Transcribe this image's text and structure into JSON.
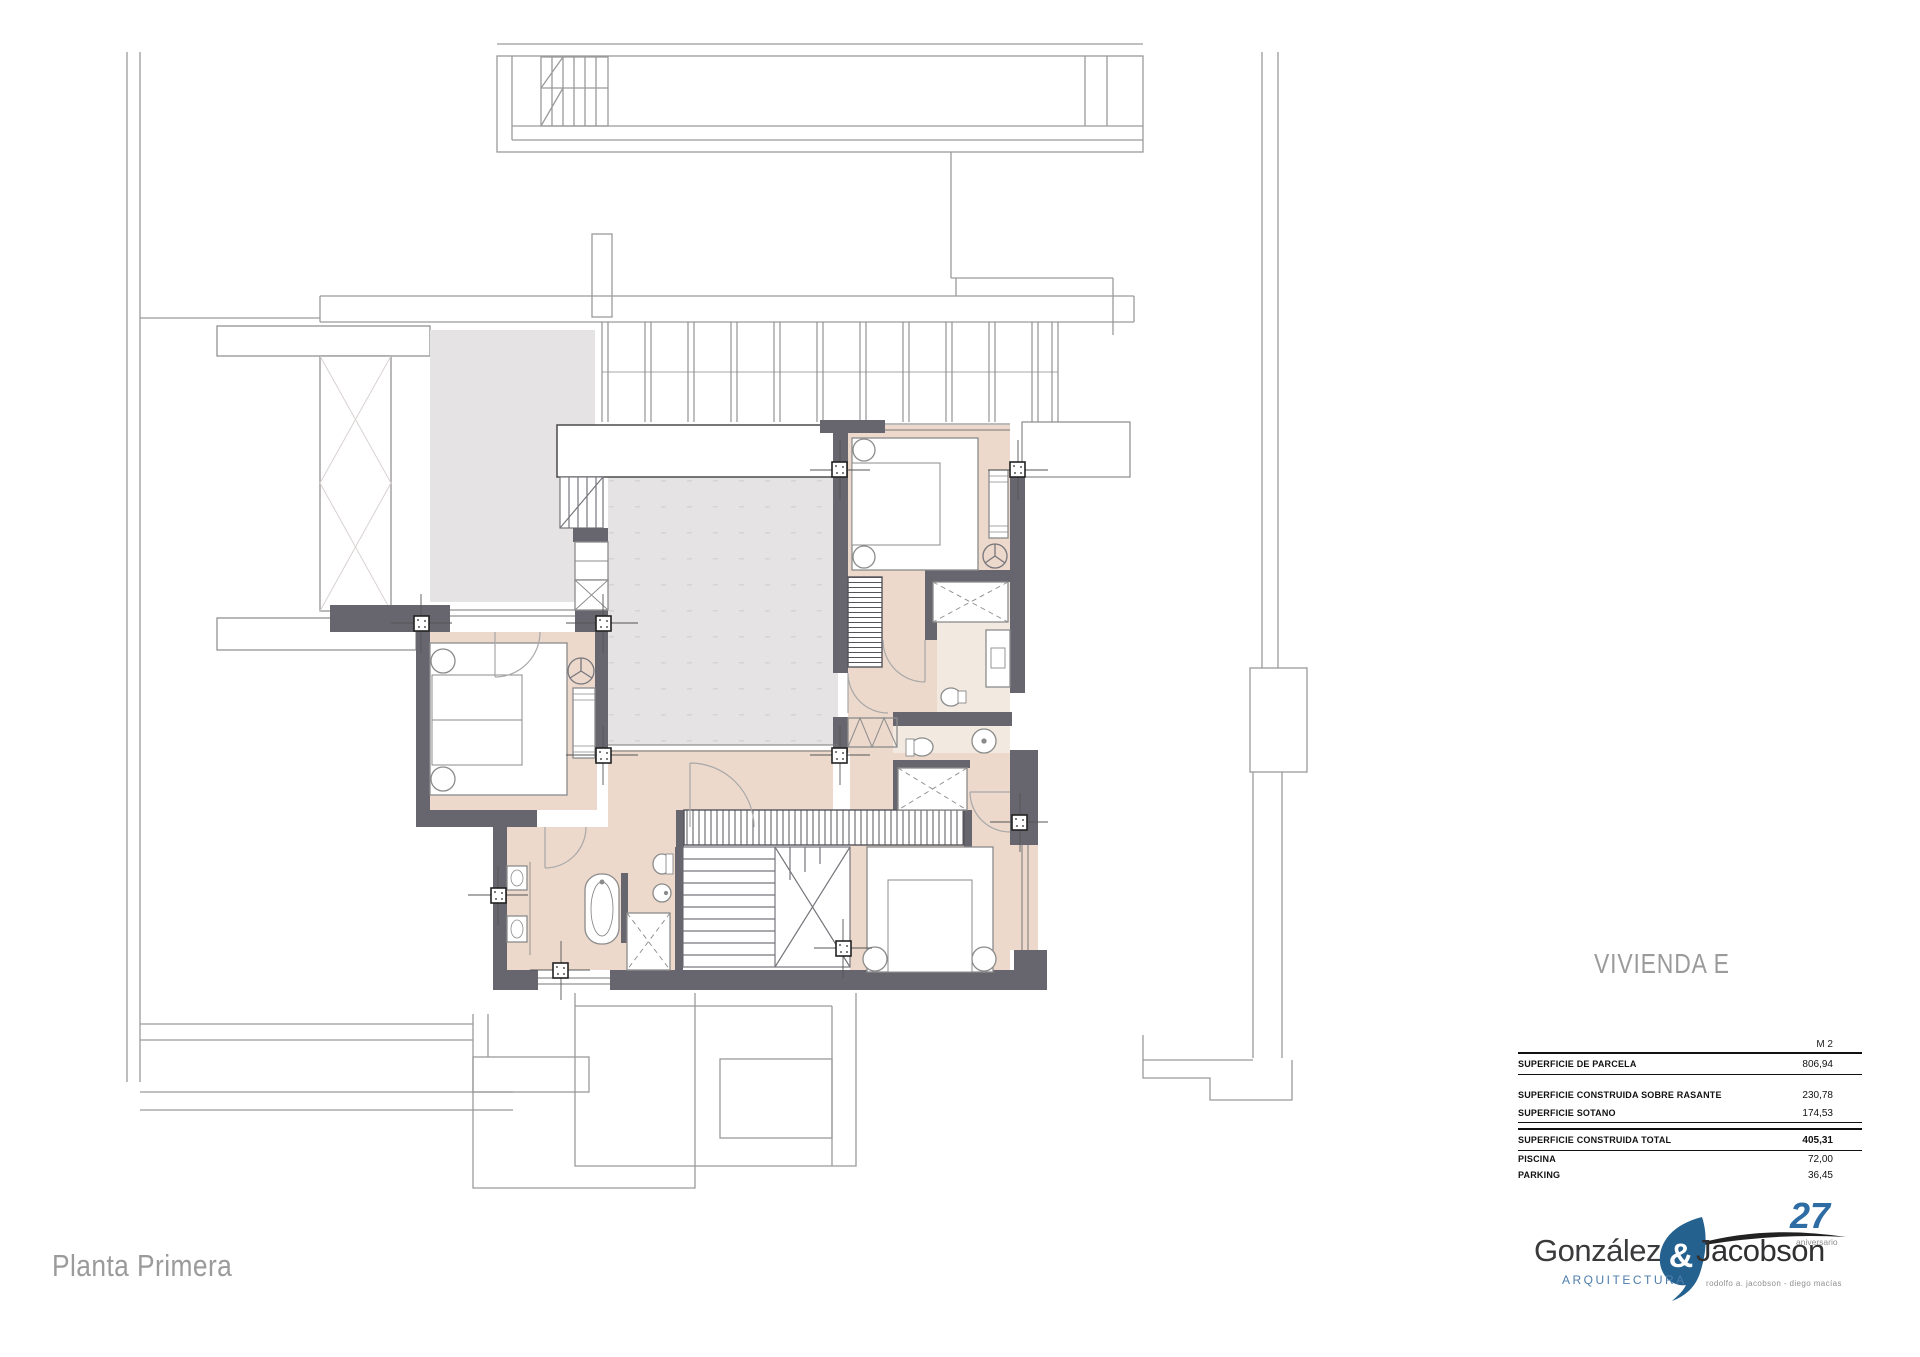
{
  "project": {
    "title": "VIVIENDA E",
    "floor_label": "Planta Primera"
  },
  "area_table": {
    "unit_header": "M 2",
    "rows": [
      {
        "label": "SUPERFICIE DE PARCELA",
        "value": "806,94"
      },
      {
        "label": "SUPERFICIE CONSTRUIDA SOBRE RASANTE",
        "value": "230,78"
      },
      {
        "label": "SUPERFICIE SOTANO",
        "value": "174,53"
      },
      {
        "label": "SUPERFICIE CONSTRUIDA TOTAL",
        "value": "405,31"
      },
      {
        "label": "PISCINA",
        "value": "72,00"
      },
      {
        "label": "PARKING",
        "value": "36,45"
      }
    ]
  },
  "logo": {
    "name_left": "González",
    "ampersand": "&",
    "name_right": "Jacobson",
    "subtitle": "ARQUITECTURA",
    "tagline": "rodolfo a. jacobson - diego macías",
    "anniversary_number": "27",
    "anniversary_label": "aniversario"
  },
  "colors": {
    "wall_dark": "#67656d",
    "floor_beige": "#ecd9cc",
    "floor_bath": "#f2e9e1",
    "void_gray": "#e5e3e3",
    "site_line": "#9a9a9a",
    "title_gray": "#9b9b9b",
    "logo_blue": "#2e6da4",
    "logo_blue_light": "#4d7dab",
    "table_text": "#111111"
  },
  "plan": {
    "drawing_kind": "first floor plan",
    "icons": [
      "bed-icon",
      "bathtub-icon",
      "toilet-icon",
      "bidet-icon",
      "sink-icon",
      "shower-icon",
      "stair-icon",
      "wardrobe-icon",
      "ceiling-fan-icon",
      "door-swing-icon",
      "column-marker-icon",
      "pergola-icon"
    ]
  }
}
